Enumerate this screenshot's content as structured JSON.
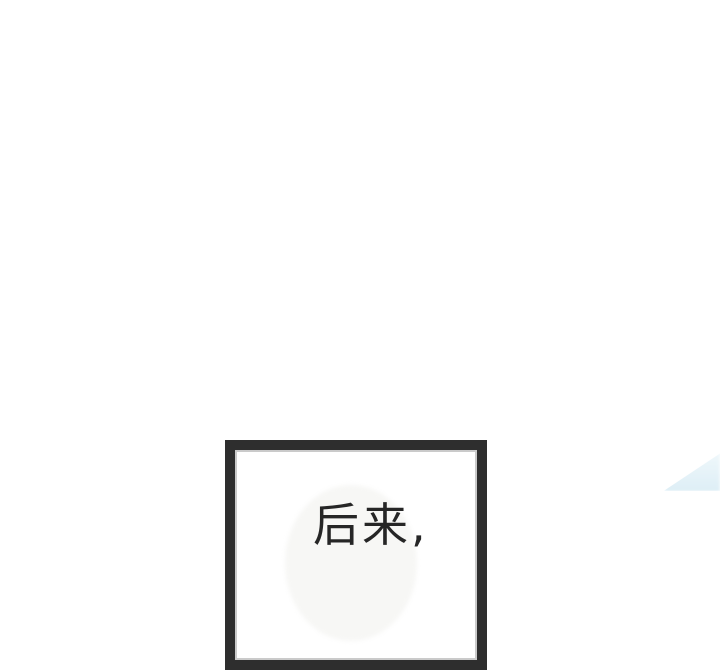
{
  "page": {
    "background_color": "#ffffff"
  },
  "panel": {
    "dialogue": "后来,",
    "border_color": "#2e2e2e",
    "text_color": "#262626",
    "bubble_color": "#f7f7f5"
  },
  "decor": {
    "fragment_color_top": "#f0f8fb",
    "fragment_color_bottom": "#ddeef6"
  }
}
